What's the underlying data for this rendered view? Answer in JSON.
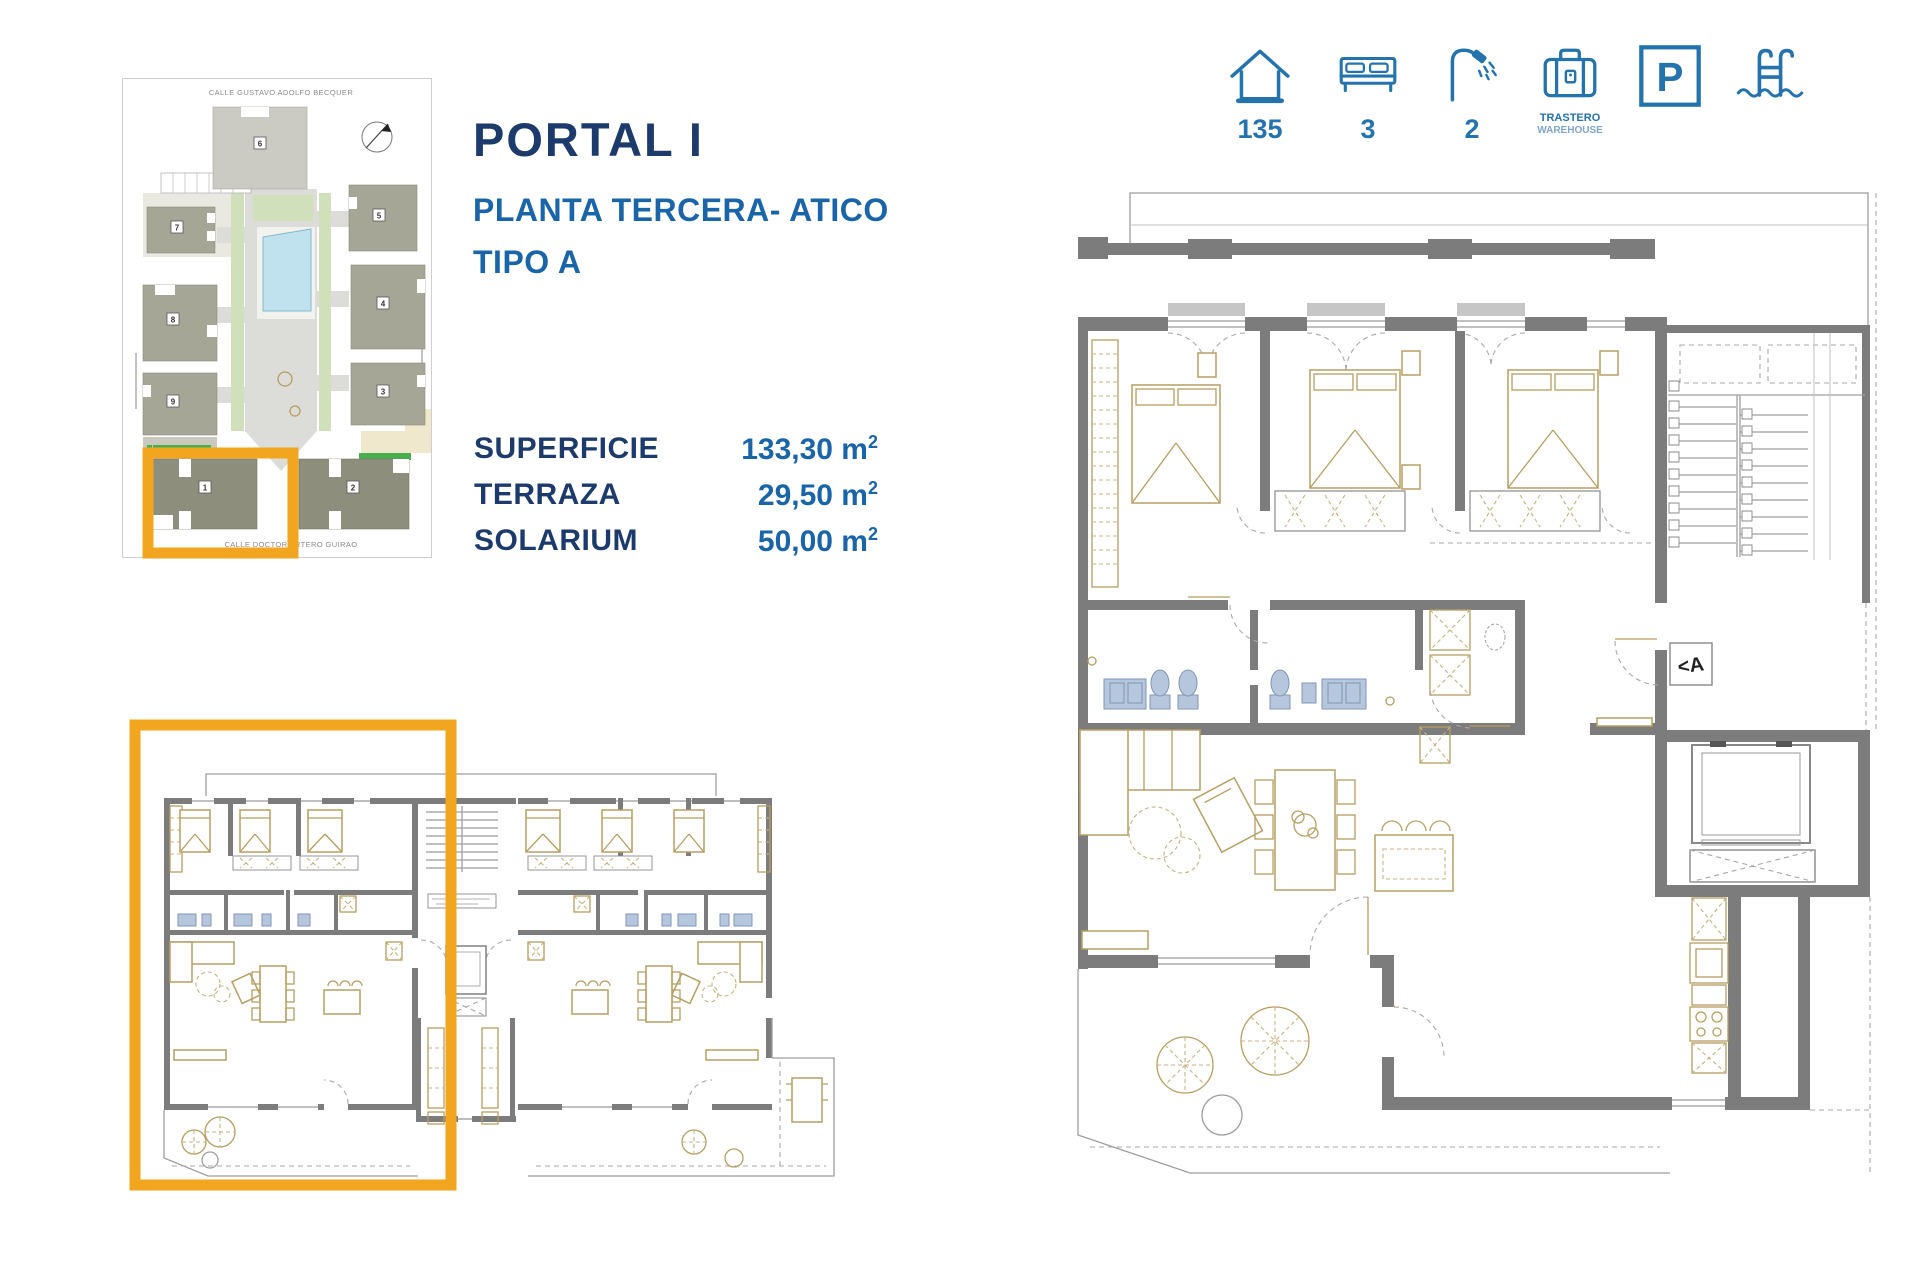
{
  "title": {
    "portal": "PORTAL I",
    "floor": "PLANTA TERCERA- ATICO",
    "tipo": "TIPO A"
  },
  "areas": {
    "rows": [
      {
        "label": "SUPERFICIE",
        "value": "133,30 m",
        "sup": "2"
      },
      {
        "label": "TERRAZA",
        "value": "29,50 m",
        "sup": "2"
      },
      {
        "label": "SOLARIUM",
        "value": "50,00 m",
        "sup": "2"
      }
    ]
  },
  "amenities": {
    "house": {
      "value": "135"
    },
    "bedrooms": {
      "value": "3"
    },
    "bathrooms": {
      "value": "2"
    },
    "storage": {
      "label_es": "TRASTERO",
      "label_en": "WAREHOUSE"
    },
    "parking": {
      "letter": "P"
    }
  },
  "site_plan": {
    "street_top": "CALLE  GUSTAVO ADOLFO BECQUER",
    "street_bottom": "CALLE  DOCTOR ARTERO GUIRAO",
    "buildings": [
      "1",
      "2",
      "3",
      "4",
      "5",
      "6",
      "7",
      "8",
      "9"
    ]
  },
  "floor_plan": {
    "section_marker": "<A"
  },
  "colors": {
    "navy": "#1C3A6B",
    "blue": "#1A64A8",
    "icon_blue": "#2473AD",
    "highlight_orange": "#F2A51F",
    "wall_gray": "#7C7C7C",
    "furniture_tan": "#B79E62",
    "fixture_blue": "#B6C6DC",
    "pool_blue": "#BFE2EE"
  }
}
